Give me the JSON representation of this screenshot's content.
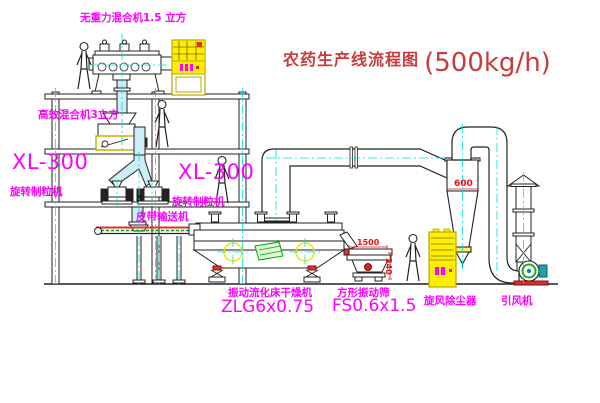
{
  "title": {
    "text": "农药生产线流程图",
    "capacity": "(500kg/h)"
  },
  "equipment_labels": {
    "gravity_free_mixer": "无重力混合机1.5 立方",
    "high_efficiency_mixer": "高效混合机3立方",
    "granulator_left_model": "XL-300",
    "granulator_left_name": "旋转制粒机",
    "granulator_center_model": "XL-300",
    "granulator_center_name": "旋转制粒机",
    "belt_conveyor": "皮带输送机",
    "fluid_bed_dryer_name": "振动流化床干燥机",
    "fluid_bed_dryer_model": "ZLG6x0.75",
    "vibrating_sieve_name": "方形振动筛",
    "vibrating_sieve_model": "FS0.6x1.5",
    "cyclone_dust_collector": "旋风除尘器",
    "induced_draft_fan": "引风机"
  },
  "dimension_labels": {
    "cyclone_diameter": "600",
    "sieve_length": "1500",
    "sieve_height": "340"
  },
  "colors": {
    "label_magenta": "#ff00ff",
    "title_red": "#cc3b3b",
    "dimension_red": "#ee1111",
    "centerline_cyan": "#00e0e0",
    "cabinet_yellow": "#ffee00",
    "belt_green": "#00a000",
    "line_black": "#1a1a1a",
    "background": "#ffffff"
  }
}
